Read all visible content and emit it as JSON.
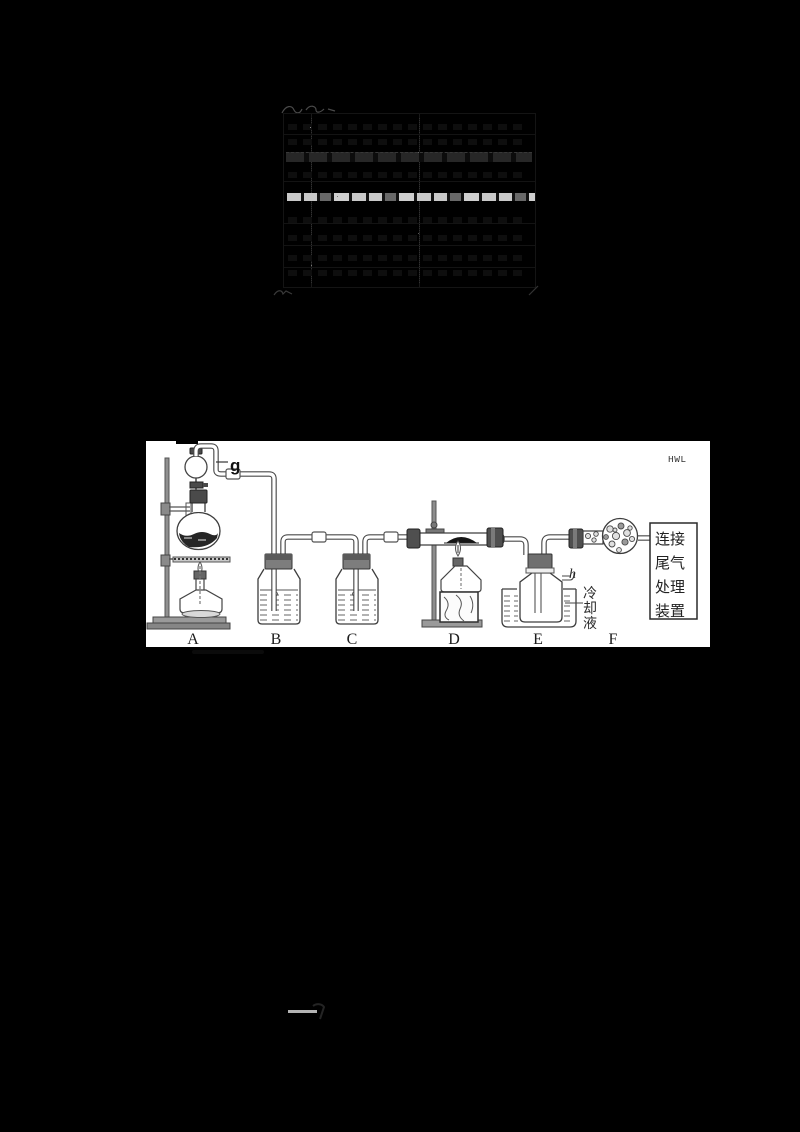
{
  "figure": {
    "watermark": "HWL",
    "apparatus_labels": [
      "A",
      "B",
      "C",
      "D",
      "E",
      "F"
    ],
    "port_g": "g",
    "port_h": "h",
    "coolant_label": "冷却液",
    "coolant_chars": [
      "冷",
      "却",
      "液"
    ],
    "tailgas_lines": [
      "连接",
      "尾气",
      "处理",
      "装置"
    ]
  },
  "colors": {
    "page_background": "#000000",
    "figure_background": "#ffffff",
    "highlight_band": "#c9c9c9",
    "table_lines": "#141414"
  }
}
